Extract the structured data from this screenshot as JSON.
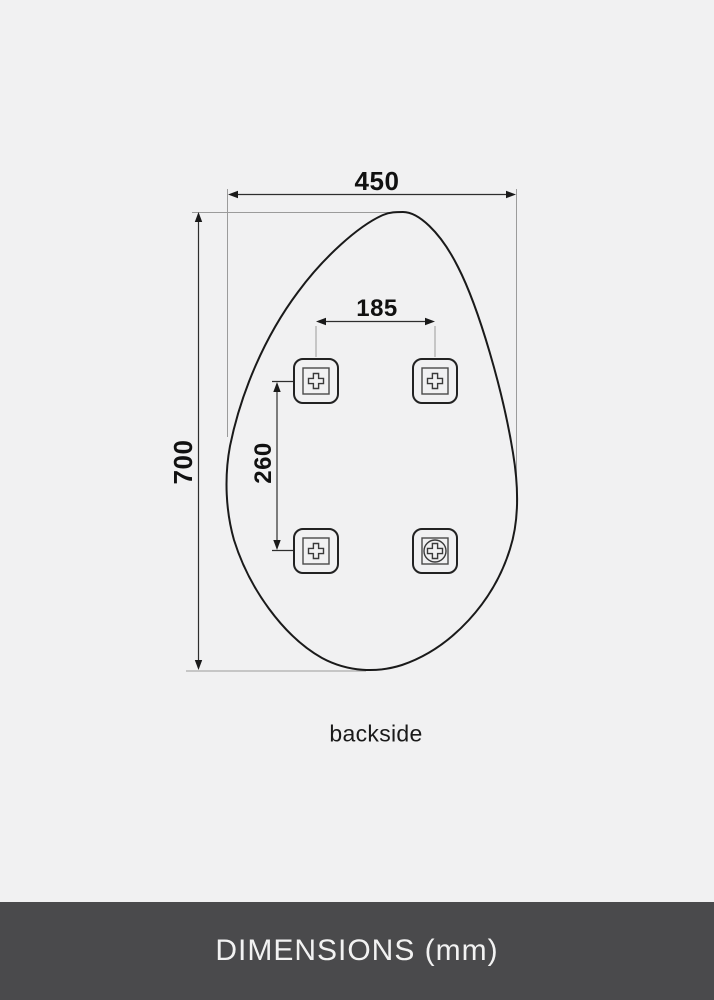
{
  "diagram": {
    "caption": "backside",
    "dimension_labels": {
      "width": "450",
      "height": "700",
      "bracket_spacing_horizontal": "185",
      "bracket_spacing_vertical": "260"
    },
    "dimensions_mm": {
      "width": 450,
      "height": 700,
      "bracket_spacing_horizontal": 185,
      "bracket_spacing_vertical": 260
    },
    "bracket_count": 4
  },
  "footer": {
    "title": "DIMENSIONS (mm)"
  },
  "colors": {
    "background": "#f1f1f2",
    "outline": "#1a1a1a",
    "dimension_line": "#2e2e2e",
    "extension_line": "#9b9b9b",
    "footer_background": "#4a4a4c",
    "footer_text": "#f2f2f2"
  }
}
